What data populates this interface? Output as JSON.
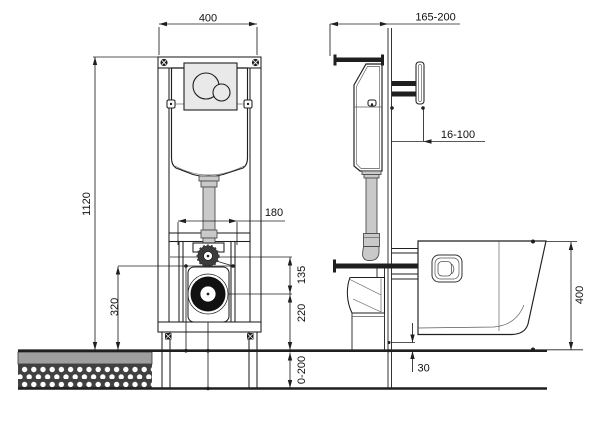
{
  "drawing": {
    "title": "concealed-cistern-frame-installation-drawing",
    "views": {
      "left": "front-view",
      "right": "side-view"
    }
  },
  "dimensions": {
    "frame_width": {
      "label": "400",
      "orientation": "horizontal",
      "view": "front"
    },
    "frame_height": {
      "label": "1120",
      "orientation": "vertical",
      "view": "front"
    },
    "bolt_spacing": {
      "label": "180",
      "orientation": "horizontal",
      "view": "front"
    },
    "inlet_height": {
      "label": "320",
      "orientation": "vertical",
      "view": "front"
    },
    "pipe_to_drain": {
      "label": "135",
      "orientation": "vertical",
      "view": "front"
    },
    "drain_height": {
      "label": "220",
      "orientation": "vertical",
      "view": "front"
    },
    "floor_adjust": {
      "label": "0-200",
      "orientation": "vertical",
      "view": "front"
    },
    "frame_depth": {
      "label": "165-200",
      "orientation": "horizontal",
      "view": "side"
    },
    "wall_offset": {
      "label": "16-100",
      "orientation": "horizontal",
      "view": "side"
    },
    "bowl_height": {
      "label": "400",
      "orientation": "vertical",
      "view": "side"
    },
    "bowl_floor_gap": {
      "label": "30",
      "orientation": "vertical",
      "view": "side"
    }
  },
  "colors": {
    "line": "#1f1f1f",
    "pipe_fill": "#c9c9c9",
    "plate_fill": "#e9e9e9",
    "floor_finish": "#9f9f9f",
    "floor_slab": "#404040",
    "drain_ring": "#111111"
  }
}
